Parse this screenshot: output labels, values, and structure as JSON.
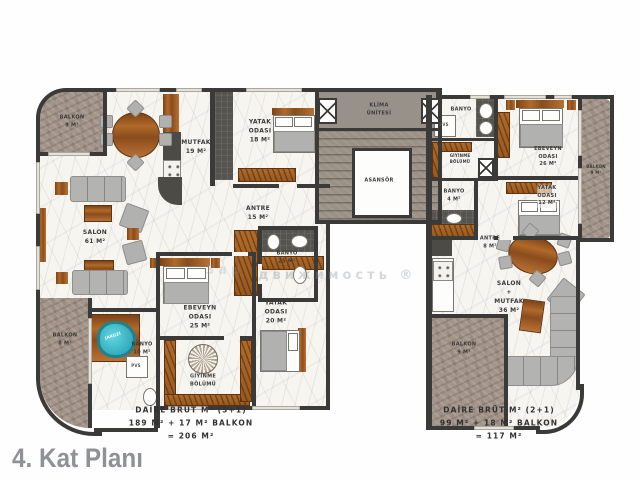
{
  "title": "4. Kat Planı",
  "watermark": "движимость ®",
  "watermark2": "Зар",
  "core": {
    "klima": "KLİMA\nÜNİTESİ",
    "asansor": "ASANSÖR"
  },
  "apartments": {
    "left": {
      "type": "3+1",
      "summary": "DAİRE BRÜT M² (3+1)\n189 M² + 17 M² BALKON\n= 206 M²",
      "rooms": {
        "balkon_ust": "BALKON\n9 M²",
        "mutfak": "MUTFAK\n19 M²",
        "yatak_odasi_ust": "YATAK\nODASI\n18 M²",
        "antre": "ANTRE\n15 M²",
        "banyo_orta": "BANYO\n25 M²",
        "salon": "SALON\n61 M²",
        "ebeveyn_odasi": "EBEVEYN\nODASI\n25 M²",
        "yatak_odasi_alt": "YATAK\nODASI\n20 M²",
        "giyinme_bolumu": "GİYİNME\nBÖLÜMÜ",
        "banyo_alt": "BANYO\n10 M²",
        "balkon_alt": "BALKON\n8 M²",
        "jakuzi": "JAKUZİ",
        "saft": "PVS"
      }
    },
    "right": {
      "type": "2+1",
      "summary": "DAİRE BRÜT M² (2+1)\n99 M² + 18 M² BALKON\n= 117 M²",
      "rooms": {
        "banyo_ust": "BANYO",
        "saft": "PVS",
        "giyinme_bolumu": "GİYİNME\nBÖLÜMÜ",
        "ebeveyn_odasi": "EBEVEYN\nODASI\n26 M²",
        "yatak_odasi": "YATAK\nODASI\n12 M²",
        "balkon_yan": "BALKON\n9 M²",
        "banyo": "BANYO\n4 M²",
        "antre": "ANTRE\n8 M²",
        "salon_mutfak": "SALON\n+\nMUTFAK\n36 M²",
        "balkon_alt": "BALKON\n9 M²"
      }
    }
  },
  "colors": {
    "wall": "#3a3a38",
    "marble_floor": "#f7f5f0",
    "stone_balcony": "#a3958a",
    "wood": "#a9631f",
    "jacuzzi": "#38b6c6",
    "title_gray": "#909195"
  }
}
